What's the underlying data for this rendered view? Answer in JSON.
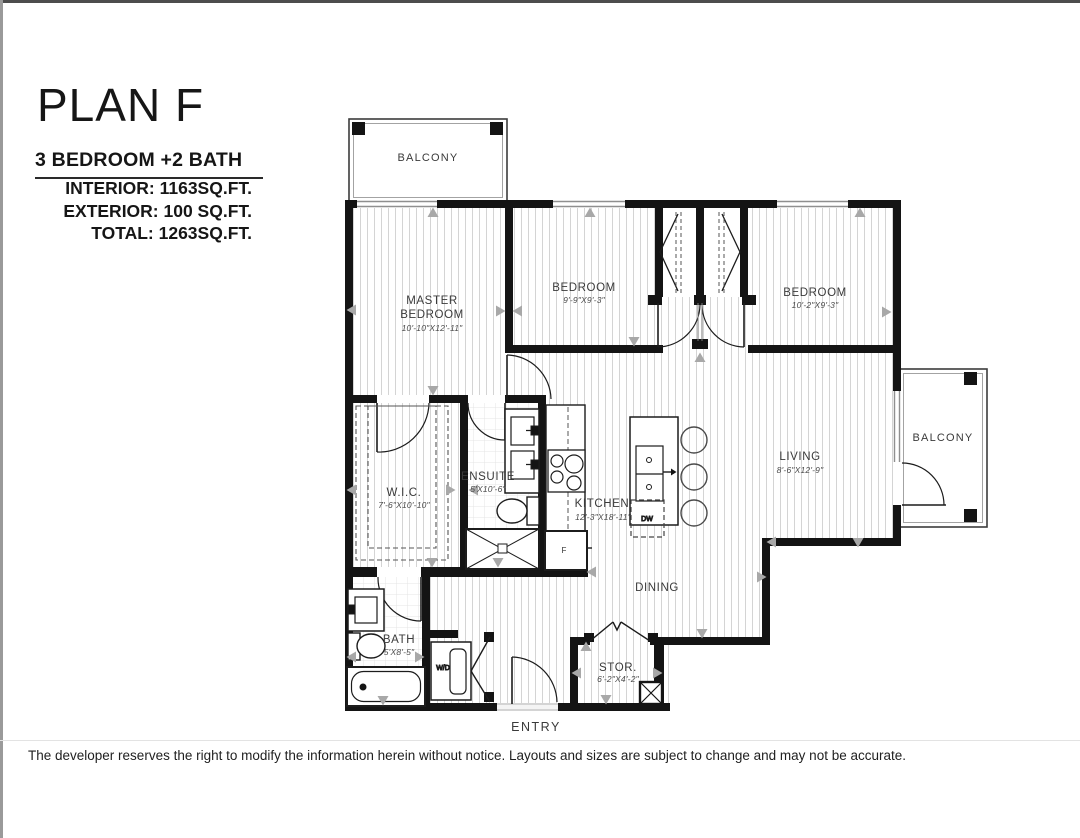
{
  "header": {
    "title": "PLAN F",
    "subtitle": "3 BEDROOM +2 BATH",
    "specs": {
      "interior": "INTERIOR: 1163SQ.FT.",
      "exterior": "EXTERIOR: 100 SQ.FT.",
      "total": "TOTAL: 1263SQ.FT."
    }
  },
  "rooms": {
    "balcony_top": {
      "name": "BALCONY"
    },
    "master": {
      "name_line1": "MASTER",
      "name_line2": "BEDROOM",
      "dims": "10'-10\"X12'-11\""
    },
    "bedroom1": {
      "name": "BEDROOM",
      "dims": "9'-9\"X9'-3\""
    },
    "bedroom2": {
      "name": "BEDROOM",
      "dims": "10'-2\"X9'-3\""
    },
    "living": {
      "name": "LIVING",
      "dims": "8'-6\"X12'-9\""
    },
    "balcony_right": {
      "name": "BALCONY"
    },
    "wic": {
      "name": "W.I.C.",
      "dims": "7'-6\"X10'-10\""
    },
    "ensuite": {
      "name": "ENSUITE",
      "dims": "5'X10'-6\""
    },
    "kitchen": {
      "name": "KITCHEN",
      "dims": "12'-3\"X18'-11\""
    },
    "dining": {
      "name": "DINING"
    },
    "bath": {
      "name": "BATH",
      "dims": "5'X8'-5\""
    },
    "stor": {
      "name": "STOR.",
      "dims": "6'-2\"X4'-2\""
    },
    "entry": {
      "name": "ENTRY"
    },
    "wd": {
      "label": "W/D"
    },
    "fridge": {
      "label": "F"
    },
    "dishwasher": {
      "label": "DW"
    }
  },
  "footer": {
    "disclaimer": "The developer reserves the right to modify the information herein without notice. Layouts and sizes are subject to change and may not be accurate."
  },
  "colors": {
    "wall": "#141414",
    "hatch": "#d4d4d4",
    "marker": "#a8a8a8"
  }
}
